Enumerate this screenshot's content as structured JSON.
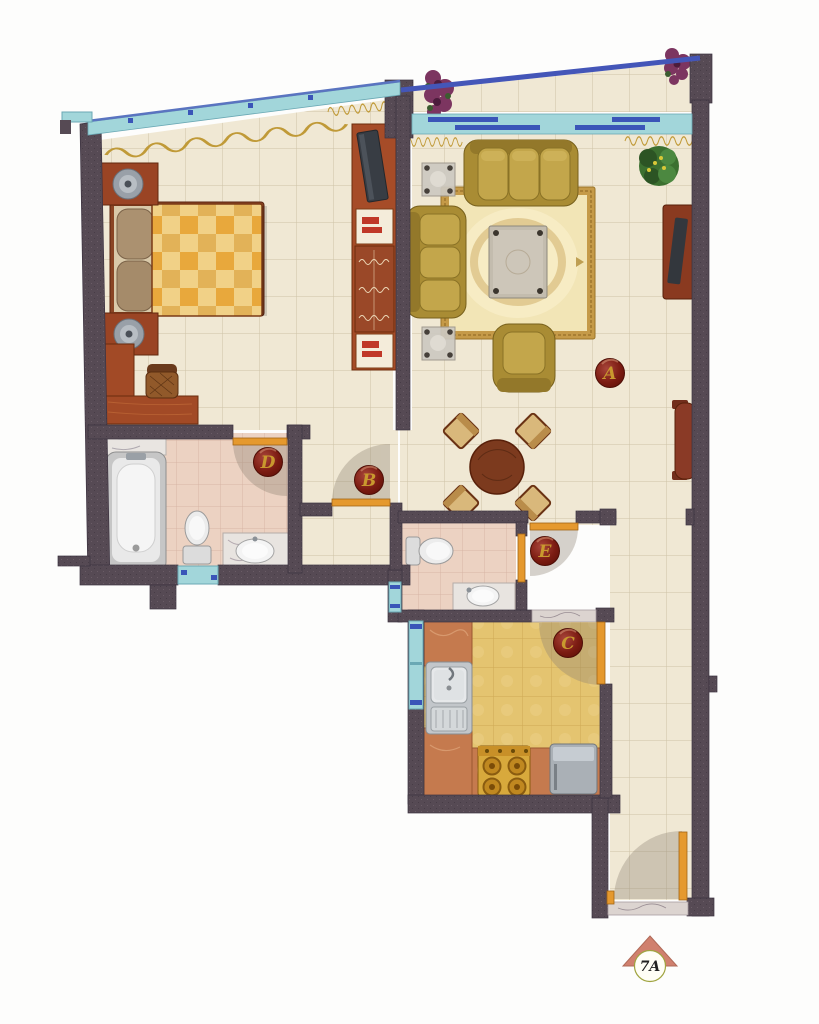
{
  "plan": {
    "type": "apartment-floor-plan",
    "rooms": [
      {
        "key": "living-room",
        "label": "A"
      },
      {
        "key": "hall",
        "label": "B"
      },
      {
        "key": "kitchen",
        "label": "C"
      },
      {
        "key": "bathroom-master",
        "label": "D"
      },
      {
        "key": "bathroom-guest",
        "label": "E"
      }
    ]
  },
  "logo": {
    "text": "7A"
  },
  "colors": {
    "wall": "#564a54",
    "tile_living": "#f0e8d4",
    "tile_bath": "#ecd2c2",
    "tile_kitchen": "#e4c470",
    "window_glass": "#a2d6da",
    "window_frame": "#3a55b8",
    "balcony_railing": "#4456b8",
    "door_leaf": "#e5992e",
    "label_badge": "#7c1c12",
    "label_text": "#c9992e",
    "wood_furniture": "#a24a26",
    "sofa_upholstery": "#b3953c",
    "bed_plaid": "#e9a93e",
    "counter_marble": "#c57a4e",
    "logo_triangle": "#d0806e"
  }
}
